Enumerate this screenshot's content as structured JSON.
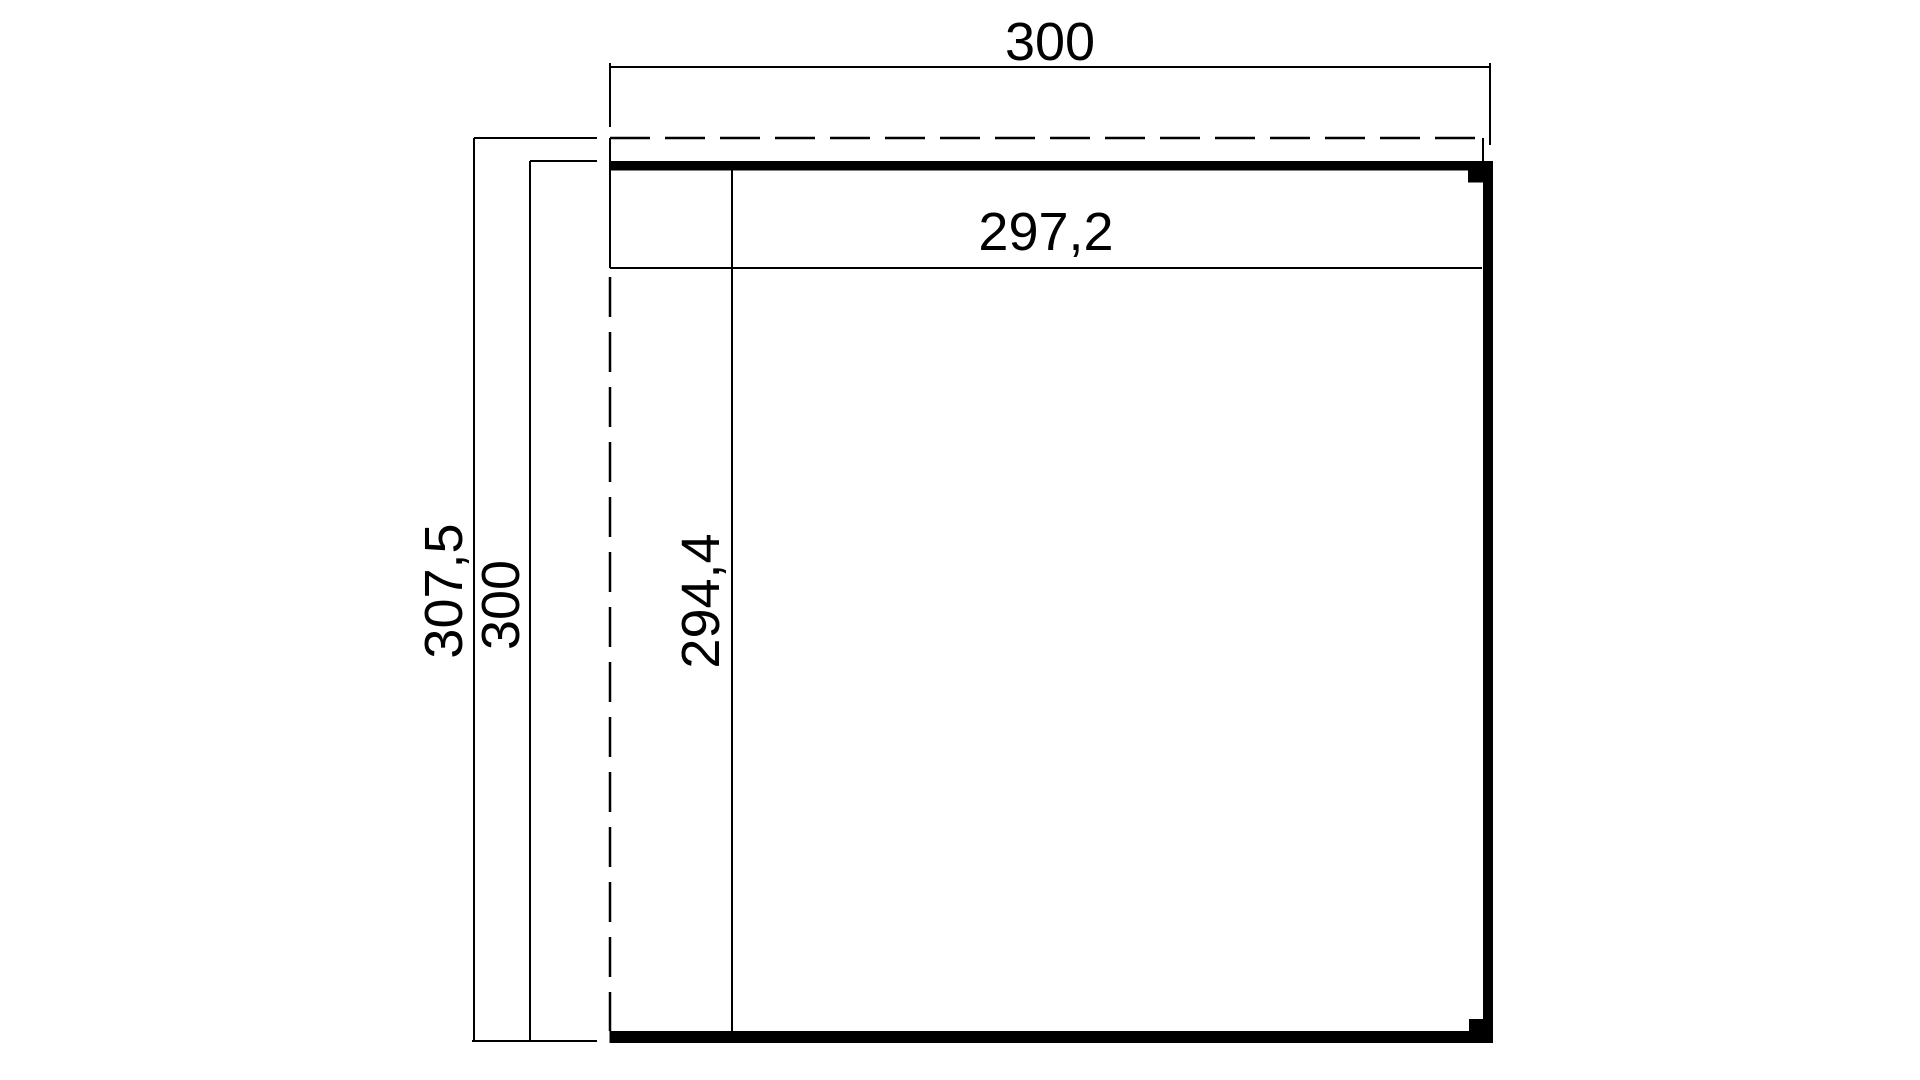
{
  "page": {
    "background": "#ffffff"
  },
  "drawing": {
    "kind": "dimensioned floor plan",
    "line_color": "#000000",
    "wall_color": "#000000",
    "dimensions": {
      "top_width": "300",
      "side_overall_depth": "307,5",
      "side_wall_depth": "300",
      "inner_depth": "294,4",
      "inner_width": "297,2"
    }
  }
}
